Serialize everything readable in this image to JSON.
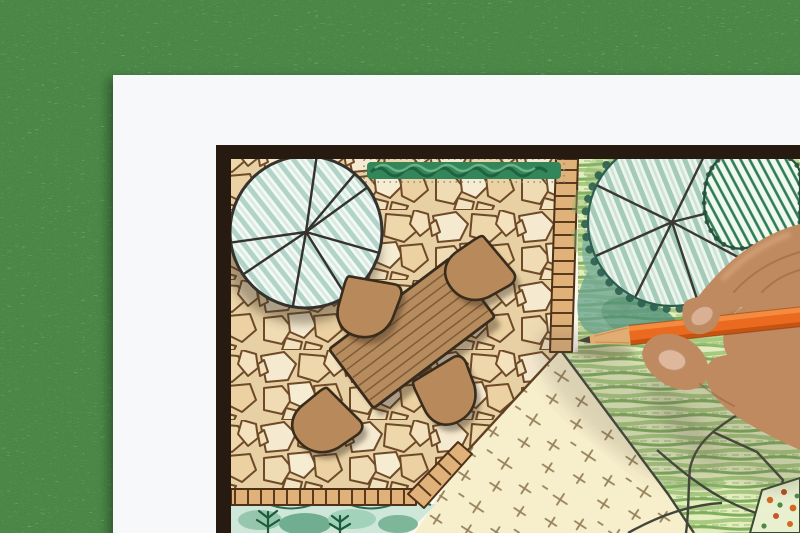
{
  "scene": {
    "description": "Overhead photo of a hand drawing a backyard garden landscape design plan with an orange colored pencil; the framed plan sheet lies on green grass",
    "background": "artificial grass lawn",
    "paper": "white sheet of drawing paper",
    "plan_border": "dark brown rectangular frame border of the plan",
    "plan_elements": [
      "flagstone patio",
      "round deciduous tree symbol with radiating branch lines",
      "clipped hedge strip",
      "brick edging / mowing strips",
      "rectangular wooden dining table with plank lines",
      "four rounded patio chairs",
      "striped lawn area",
      "sand court with cross hatch marks",
      "planting bed with ferns",
      "large shade tree with scalloped canopy",
      "hatched evergreen shrub",
      "stepping path lines",
      "corner flower bed with orange blooms"
    ],
    "hand": "right hand entering from the right edge, fingers pinching an orange colored pencil, tip touching the plan at the patio corner"
  },
  "colors": {
    "grass_base": "#4b8039",
    "paper": "#f7f8f9",
    "frame": "#271b11",
    "plan_paper": "#fcf8ee",
    "patio_mortar": "#e7d0a4",
    "stone_outline": "#6e4a28",
    "brick": "#e0b27a",
    "brick_outline": "#4e3118",
    "hedge_green": "#33865a",
    "lawn_base": "#e3edbe",
    "sand": "#f7eecb",
    "sand_mark": "#96825a",
    "tree_outline": "#35322d",
    "scallop_green": "#2e5e50",
    "shrub_green": "#2e7d52",
    "furniture_wood": "#b68c5e",
    "furniture_outline": "#3a2c1c",
    "bed_teal": "#cfe7d9",
    "fern_green": "#1d5c3a",
    "flower_orange": "#d2691e",
    "pencil_body": "#ea6a1f",
    "pencil_highlight": "#f68f42",
    "pencil_shade": "#c14f12",
    "pencil_wood": "#e2ad72",
    "pencil_lead": "#4a4238",
    "skin": "#c08a60",
    "skin_shadow": "#9a6a44",
    "skin_light": "#e6b78f",
    "nail": "#dcb396"
  }
}
